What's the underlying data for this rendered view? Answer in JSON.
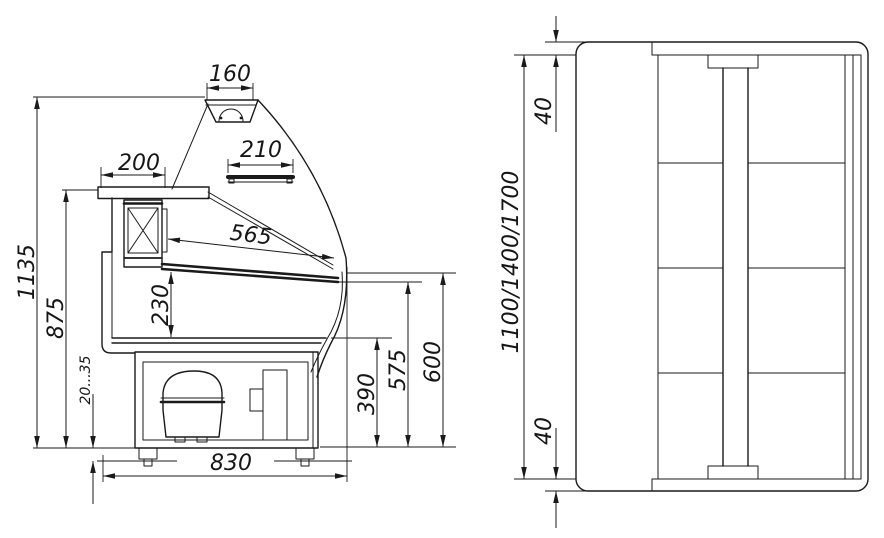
{
  "colors": {
    "line": "#1a1a1a",
    "background": "#ffffff"
  },
  "side": {
    "dims": {
      "canopy_width": "160",
      "rear_top_depth": "200",
      "shelf_depth": "210",
      "display_deck_length": "565",
      "well_depth": "230",
      "overall_height": "1135",
      "worktop_height": "875",
      "leg_height_range": "20...35",
      "overall_depth": "830",
      "base_front_height": "390",
      "glass_lower_edge_height": "575",
      "front_height": "600"
    }
  },
  "plan": {
    "dims": {
      "end_wall_top": "40",
      "end_wall_bottom": "40",
      "length_variants": "1100/1400/1700"
    }
  }
}
